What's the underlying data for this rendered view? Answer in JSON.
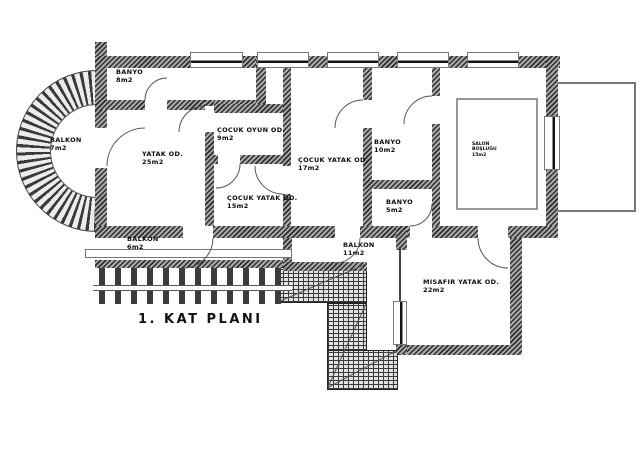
{
  "title": "1. KAT PLANI",
  "rooms": {
    "banyo_top": {
      "name": "BANYO",
      "area": "8m2"
    },
    "balkon_round": {
      "name": "BALKON",
      "area": "7m2"
    },
    "yatak": {
      "name": "YATAK OD.",
      "area": "25m2"
    },
    "cocuk_oyun": {
      "name": "ÇOCUK OYUN OD.",
      "area": "9m2"
    },
    "cocuk_yatak_buyuk": {
      "name": "ÇOCUK YATAK OD.",
      "area": "17m2"
    },
    "banyo_orta": {
      "name": "BANYO",
      "area": "10m2"
    },
    "cocuk_yatak_kucuk": {
      "name": "ÇOCUK YATAK OD.",
      "area": "15m2"
    },
    "banyo_kucuk": {
      "name": "BANYO",
      "area": "5m2"
    },
    "salon_boslugu": {
      "name": "SALON",
      "name2": "BOŞLUĞU",
      "area": "15m2"
    },
    "balkon_alt": {
      "name": "BALKON",
      "area": "6m2"
    },
    "balkon_orta": {
      "name": "BALKON",
      "area": "11m2"
    },
    "misafir": {
      "name": "MISAFIR YATAK OD.",
      "area": "22m2"
    }
  },
  "colors": {
    "wall_dark": "#2f2f2f",
    "wall_light": "#a8a8a8",
    "paving_line": "#3a3a3a",
    "outline": "#555555",
    "background": "#ffffff"
  }
}
